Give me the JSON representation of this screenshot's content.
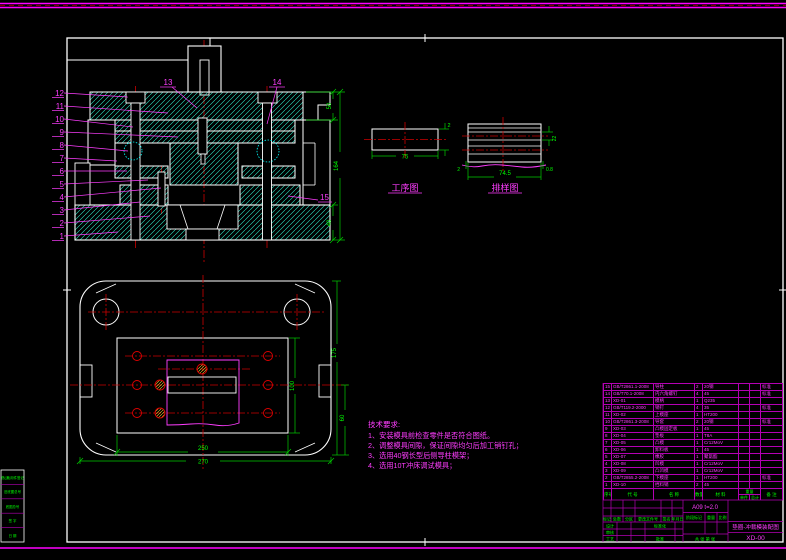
{
  "sheet": {
    "bg": "#000000",
    "frame_color": "#ffffff",
    "border_color": "#ff00ff",
    "green": "#00ff00",
    "red": "#cc0000",
    "hatch": "#2de8c8"
  },
  "balloons": {
    "left": [
      "12",
      "11",
      "10",
      "9",
      "8",
      "7",
      "6",
      "5",
      "4",
      "3",
      "2",
      "1"
    ],
    "top": [
      "13",
      "14"
    ],
    "right": [
      "15"
    ]
  },
  "dims": {
    "main_right": [
      "50",
      "164",
      "40"
    ],
    "plan_bottom": [
      "250",
      "270"
    ],
    "plan_right": [
      "175",
      "100",
      "60"
    ],
    "process": {
      "width": "75",
      "thickness": "2"
    },
    "strip": {
      "pitch": "74.5",
      "width": "22",
      "margin_left": "2",
      "margin_right": "0.8"
    }
  },
  "views": {
    "process_label": "工序图",
    "strip_label": "排样图"
  },
  "notes": {
    "title": "技术要求:",
    "items": [
      "1、安装模具前检查零件是否符合图纸。",
      "2、调整模具间隙，保证间隙均匀后加工销钉孔；",
      "3、选用40钢长型后侧导柱模架；",
      "4、选用10T冲床调试模具；"
    ]
  },
  "bom": {
    "headers": {
      "no": "序号",
      "code": "代 号",
      "name": "名 称",
      "qty": "数量",
      "material": "材 料",
      "weight": "重量",
      "each": "单件",
      "total": "总计",
      "remark": "备 注"
    },
    "rows": [
      {
        "no": "15",
        "code": "GB/T2861.1-2008",
        "name": "导柱",
        "qty": "2",
        "material": "20钢",
        "each": "",
        "total": "",
        "remark": "标准"
      },
      {
        "no": "14",
        "code": "GB/T70.1-2008",
        "name": "内六角螺钉",
        "qty": "4",
        "material": "45",
        "each": "",
        "total": "",
        "remark": "标准"
      },
      {
        "no": "13",
        "code": "XD-01",
        "name": "模柄",
        "qty": "1",
        "material": "Q235",
        "each": "",
        "total": "",
        "remark": ""
      },
      {
        "no": "12",
        "code": "GB/T119.2-2000",
        "name": "销钉",
        "qty": "4",
        "material": "35",
        "each": "",
        "total": "",
        "remark": "标准"
      },
      {
        "no": "11",
        "code": "XD-02",
        "name": "上模座",
        "qty": "1",
        "material": "HT200",
        "each": "",
        "total": "",
        "remark": ""
      },
      {
        "no": "10",
        "code": "GB/T2861.3-2008",
        "name": "导套",
        "qty": "2",
        "material": "20钢",
        "each": "",
        "total": "",
        "remark": "标准"
      },
      {
        "no": "9",
        "code": "XD-03",
        "name": "凸模固定板",
        "qty": "1",
        "material": "45",
        "each": "",
        "total": "",
        "remark": ""
      },
      {
        "no": "8",
        "code": "XD-04",
        "name": "垫板",
        "qty": "1",
        "material": "T8A",
        "each": "",
        "total": "",
        "remark": ""
      },
      {
        "no": "7",
        "code": "XD-05",
        "name": "凸模",
        "qty": "1",
        "material": "Cr12MoV",
        "each": "",
        "total": "",
        "remark": ""
      },
      {
        "no": "6",
        "code": "XD-06",
        "name": "卸料板",
        "qty": "1",
        "material": "45",
        "each": "",
        "total": "",
        "remark": ""
      },
      {
        "no": "5",
        "code": "XD-07",
        "name": "橡胶",
        "qty": "1",
        "material": "聚氨酯",
        "each": "",
        "total": "",
        "remark": ""
      },
      {
        "no": "4",
        "code": "XD-08",
        "name": "凹模",
        "qty": "1",
        "material": "Cr12MoV",
        "each": "",
        "total": "",
        "remark": ""
      },
      {
        "no": "3",
        "code": "XD-09",
        "name": "凸凹模",
        "qty": "1",
        "material": "Cr12MoV",
        "each": "",
        "total": "",
        "remark": ""
      },
      {
        "no": "2",
        "code": "GB/T2855.2-2008",
        "name": "下模座",
        "qty": "1",
        "material": "HT200",
        "each": "",
        "total": "",
        "remark": "标准"
      },
      {
        "no": "1",
        "code": "XD-10",
        "name": "挡料销",
        "qty": "2",
        "material": "45",
        "each": "",
        "total": "",
        "remark": ""
      }
    ]
  },
  "titleblock": {
    "revision_labels": [
      "标记",
      "处数",
      "分区",
      "更改文件号",
      "签名",
      "年月日"
    ],
    "role_labels": [
      "设计",
      "审核",
      "工艺",
      "标准化",
      "批准"
    ],
    "stage_labels": [
      "阶段标记",
      "重量",
      "比例"
    ],
    "sheet_label": "共 张 第 张",
    "material_spec": "A09  t=2.0",
    "title": "垫圈-冲裁模装配图",
    "drawing_no": "XD-00"
  },
  "margin": {
    "rows": [
      "借(通)用件登记",
      "旧底图总号",
      "底图总号",
      "签 字",
      "日 期"
    ]
  }
}
